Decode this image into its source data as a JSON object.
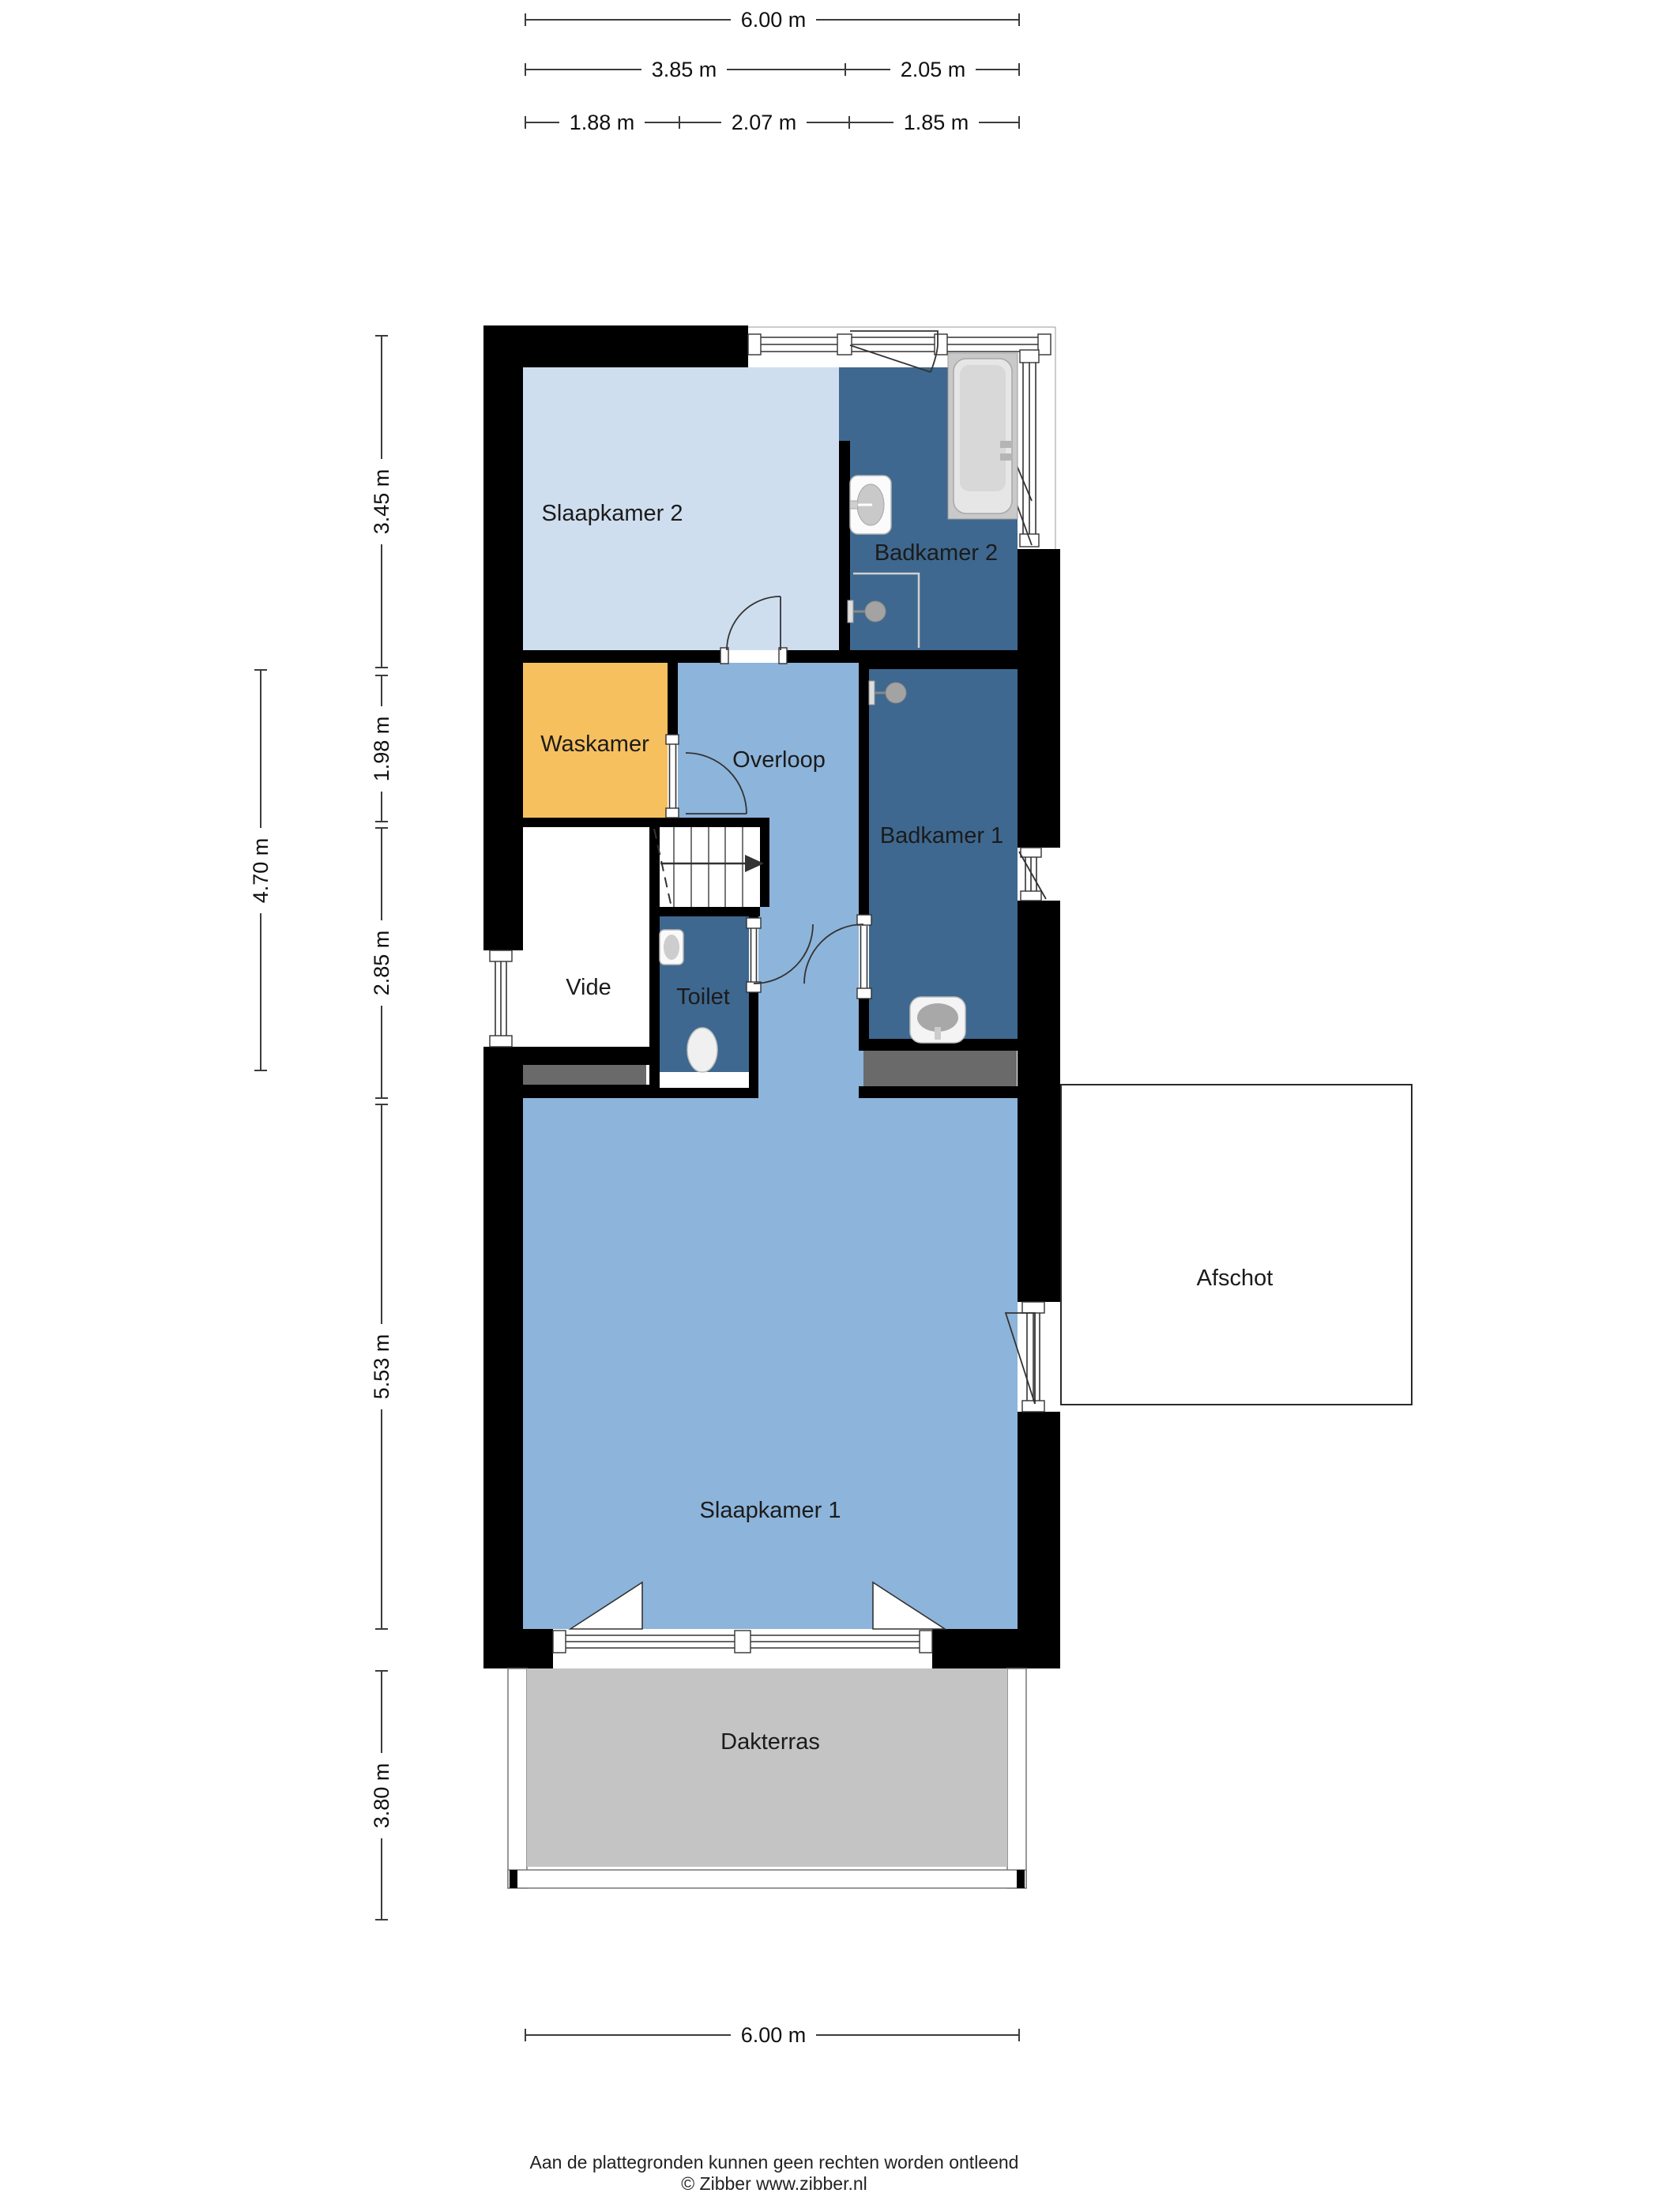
{
  "title": "Floor plan (verdieping)",
  "rooms": [
    {
      "name": "Slaapkamer 2"
    },
    {
      "name": "Badkamer 2"
    },
    {
      "name": "Waskamer"
    },
    {
      "name": "Overloop"
    },
    {
      "name": "Badkamer 1"
    },
    {
      "name": "Vide"
    },
    {
      "name": "Toilet"
    },
    {
      "name": "Slaapkamer 1"
    },
    {
      "name": "Afschot"
    },
    {
      "name": "Dakterras"
    }
  ],
  "dimensions": {
    "top_row1": [
      {
        "label": "6.00 m"
      }
    ],
    "top_row2": [
      {
        "label": "3.85 m"
      },
      {
        "label": "2.05 m"
      }
    ],
    "top_row3": [
      {
        "label": "1.88 m"
      },
      {
        "label": "2.07 m"
      },
      {
        "label": "1.85 m"
      }
    ],
    "left": [
      {
        "label": "3.45 m"
      },
      {
        "label": "1.98 m"
      },
      {
        "label": "2.85 m"
      },
      {
        "label": "4.70 m"
      },
      {
        "label": "5.53 m"
      },
      {
        "label": "3.80 m"
      }
    ],
    "bottom": [
      {
        "label": "6.00 m"
      }
    ]
  },
  "footer": {
    "line1": "Aan de plattegronden kunnen geen rechten worden ontleend",
    "line2": "© Zibber www.zibber.nl"
  },
  "palette": {
    "wall_black": "#000000",
    "bedroom_light_blue": "#cfdeef",
    "bedroom_medium_blue": "#8db4da",
    "bathroom_blue": "#3e688f",
    "laundry_orange": "#f6c05f",
    "terrace_gray": "#c4c4c4",
    "counter_gray": "#6a6a6a",
    "fixture_gray": "#c9c9c9"
  },
  "icons": [
    {
      "name": "bathtub-icon"
    },
    {
      "name": "sink-icon"
    },
    {
      "name": "shower-icon"
    },
    {
      "name": "toilet-icon"
    },
    {
      "name": "stairs-arrow-icon"
    },
    {
      "name": "door-swing-icon"
    },
    {
      "name": "window-icon"
    }
  ]
}
